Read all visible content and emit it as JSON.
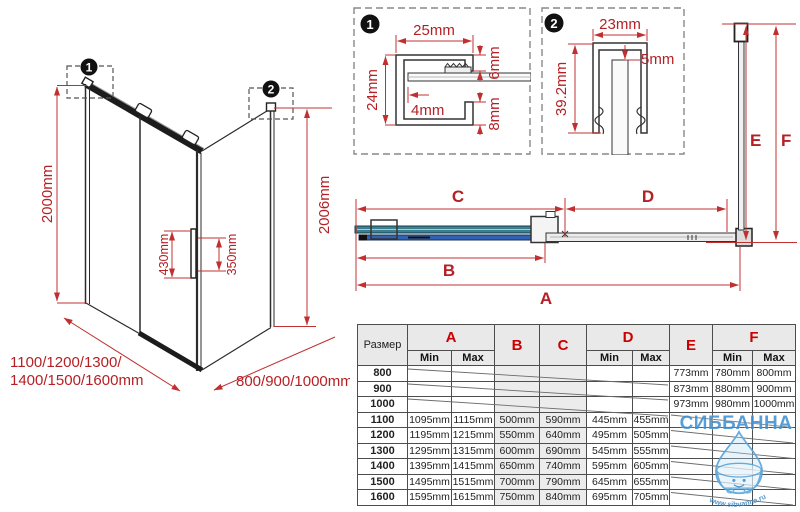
{
  "colors": {
    "dimension_red": "#c03030",
    "label_red": "#b52025",
    "table_letter_red": "#cc0000",
    "glass_teal": "#3b7f90",
    "glass_blue": "#2f62b5",
    "watermark_blue": "#4a9ad0"
  },
  "iso": {
    "callout1_num": "1",
    "callout2_num": "2",
    "height_left": "2000mm",
    "height_right": "2006mm",
    "handle_outer": "430mm",
    "handle_inner": "350mm",
    "front_widths_line1": "1100/1200/1300/",
    "front_widths_line2": "1400/1500/1600mm",
    "side_widths": "800/900/1000mm"
  },
  "detail1": {
    "num": "1",
    "dim_top": "25mm",
    "dim_left": "24mm",
    "dim_right_top": "6mm",
    "dim_inner": "4mm",
    "dim_right_bottom": "8mm"
  },
  "detail2": {
    "num": "2",
    "dim_top": "23mm",
    "dim_gap": "5mm",
    "dim_left": "39.2mm"
  },
  "plan": {
    "dim_a": "A",
    "dim_b": "B",
    "dim_c": "C",
    "dim_d": "D",
    "dim_e": "E",
    "dim_f": "F"
  },
  "table": {
    "size_header": "Размер",
    "col_a": "A",
    "col_b": "B",
    "col_c": "C",
    "col_d": "D",
    "col_e": "E",
    "col_f": "F",
    "min_label": "Min",
    "max_label": "Max",
    "rows": [
      [
        "800",
        "",
        "",
        "",
        "",
        "",
        "",
        "773mm",
        "780mm",
        "800mm"
      ],
      [
        "900",
        "",
        "",
        "",
        "",
        "",
        "",
        "873mm",
        "880mm",
        "900mm"
      ],
      [
        "1000",
        "",
        "",
        "",
        "",
        "",
        "",
        "973mm",
        "980mm",
        "1000mm"
      ],
      [
        "1100",
        "1095mm",
        "1115mm",
        "500mm",
        "590mm",
        "445mm",
        "455mm",
        "",
        "",
        ""
      ],
      [
        "1200",
        "1195mm",
        "1215mm",
        "550mm",
        "640mm",
        "495mm",
        "505mm",
        "",
        "",
        ""
      ],
      [
        "1300",
        "1295mm",
        "1315mm",
        "600mm",
        "690mm",
        "545mm",
        "555mm",
        "",
        "",
        ""
      ],
      [
        "1400",
        "1395mm",
        "1415mm",
        "650mm",
        "740mm",
        "595mm",
        "605mm",
        "",
        "",
        ""
      ],
      [
        "1500",
        "1495mm",
        "1515mm",
        "700mm",
        "790mm",
        "645mm",
        "655mm",
        "",
        "",
        ""
      ],
      [
        "1600",
        "1595mm",
        "1615mm",
        "750mm",
        "840mm",
        "695mm",
        "705mm",
        "",
        "",
        ""
      ]
    ]
  },
  "watermark": {
    "brand": "СИББАННА",
    "url": "www.sibvanna.ru"
  }
}
